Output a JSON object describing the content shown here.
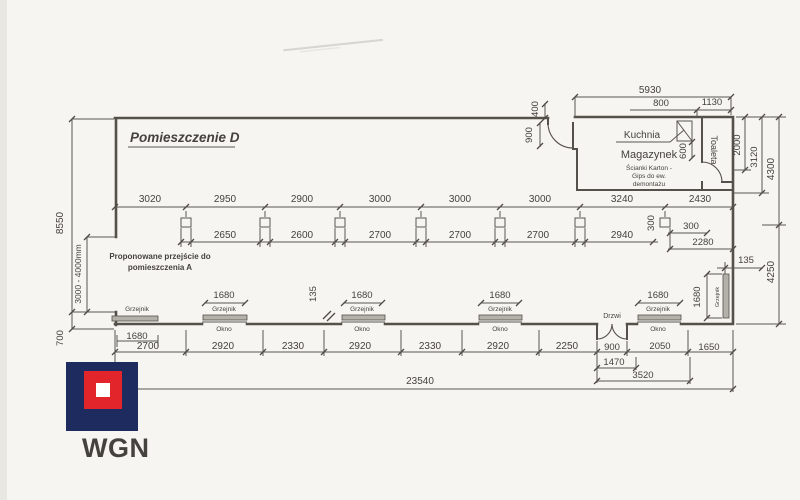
{
  "colors": {
    "paper": "#f6f5f1",
    "ink": "#54504a",
    "logo_navy": "#1d2b5f",
    "logo_red": "#e2252b",
    "logo_inner": "#ffffff"
  },
  "logo": {
    "name": "WGN"
  },
  "title": {
    "room": "Pomieszczenie D"
  },
  "note": {
    "line1": "Proponowane przejście do",
    "line2": "pomieszczenia  A"
  },
  "rooms": {
    "kuchnia": "Kuchnia",
    "magazynek": "Magazynek",
    "toaleta": "Toaleta",
    "mag_note1": "Ścianki Karton -",
    "mag_note2": "Gips do ew.",
    "mag_note3": "demontażu"
  },
  "labels": {
    "grzejnik": "Grzejnik",
    "okno": "Okno",
    "drzwi": "Drzwi"
  },
  "dims": {
    "top": {
      "a5930": "5930",
      "a800": "800",
      "a1130": "1130",
      "a400": "400",
      "a900": "900",
      "a600": "600"
    },
    "right": {
      "a2000": "2000",
      "a3120": "3120",
      "a4300": "4300",
      "a4250": "4250",
      "a135": "135",
      "a1680": "1680"
    },
    "left": {
      "a8550": "8550",
      "range": "3000 - 4000mm",
      "a700": "700"
    },
    "top_chain": [
      "3020",
      "2950",
      "2900",
      "3000",
      "3000",
      "3000",
      "3240",
      "2430"
    ],
    "mid_chain": [
      "2650",
      "2600",
      "2700",
      "2700",
      "2700",
      "2940"
    ],
    "mid_extra": {
      "v300": "300",
      "h300": "300",
      "a2280": "2280"
    },
    "win": {
      "a1680": "1680",
      "a135": "135"
    },
    "bottom_chain": [
      "2700",
      "2920",
      "2330",
      "2920",
      "2330",
      "2920",
      "2250",
      "900",
      "2050",
      "1650"
    ],
    "bottom_extra": {
      "a1470": "1470",
      "a3520": "3520",
      "a23540": "23540"
    }
  }
}
